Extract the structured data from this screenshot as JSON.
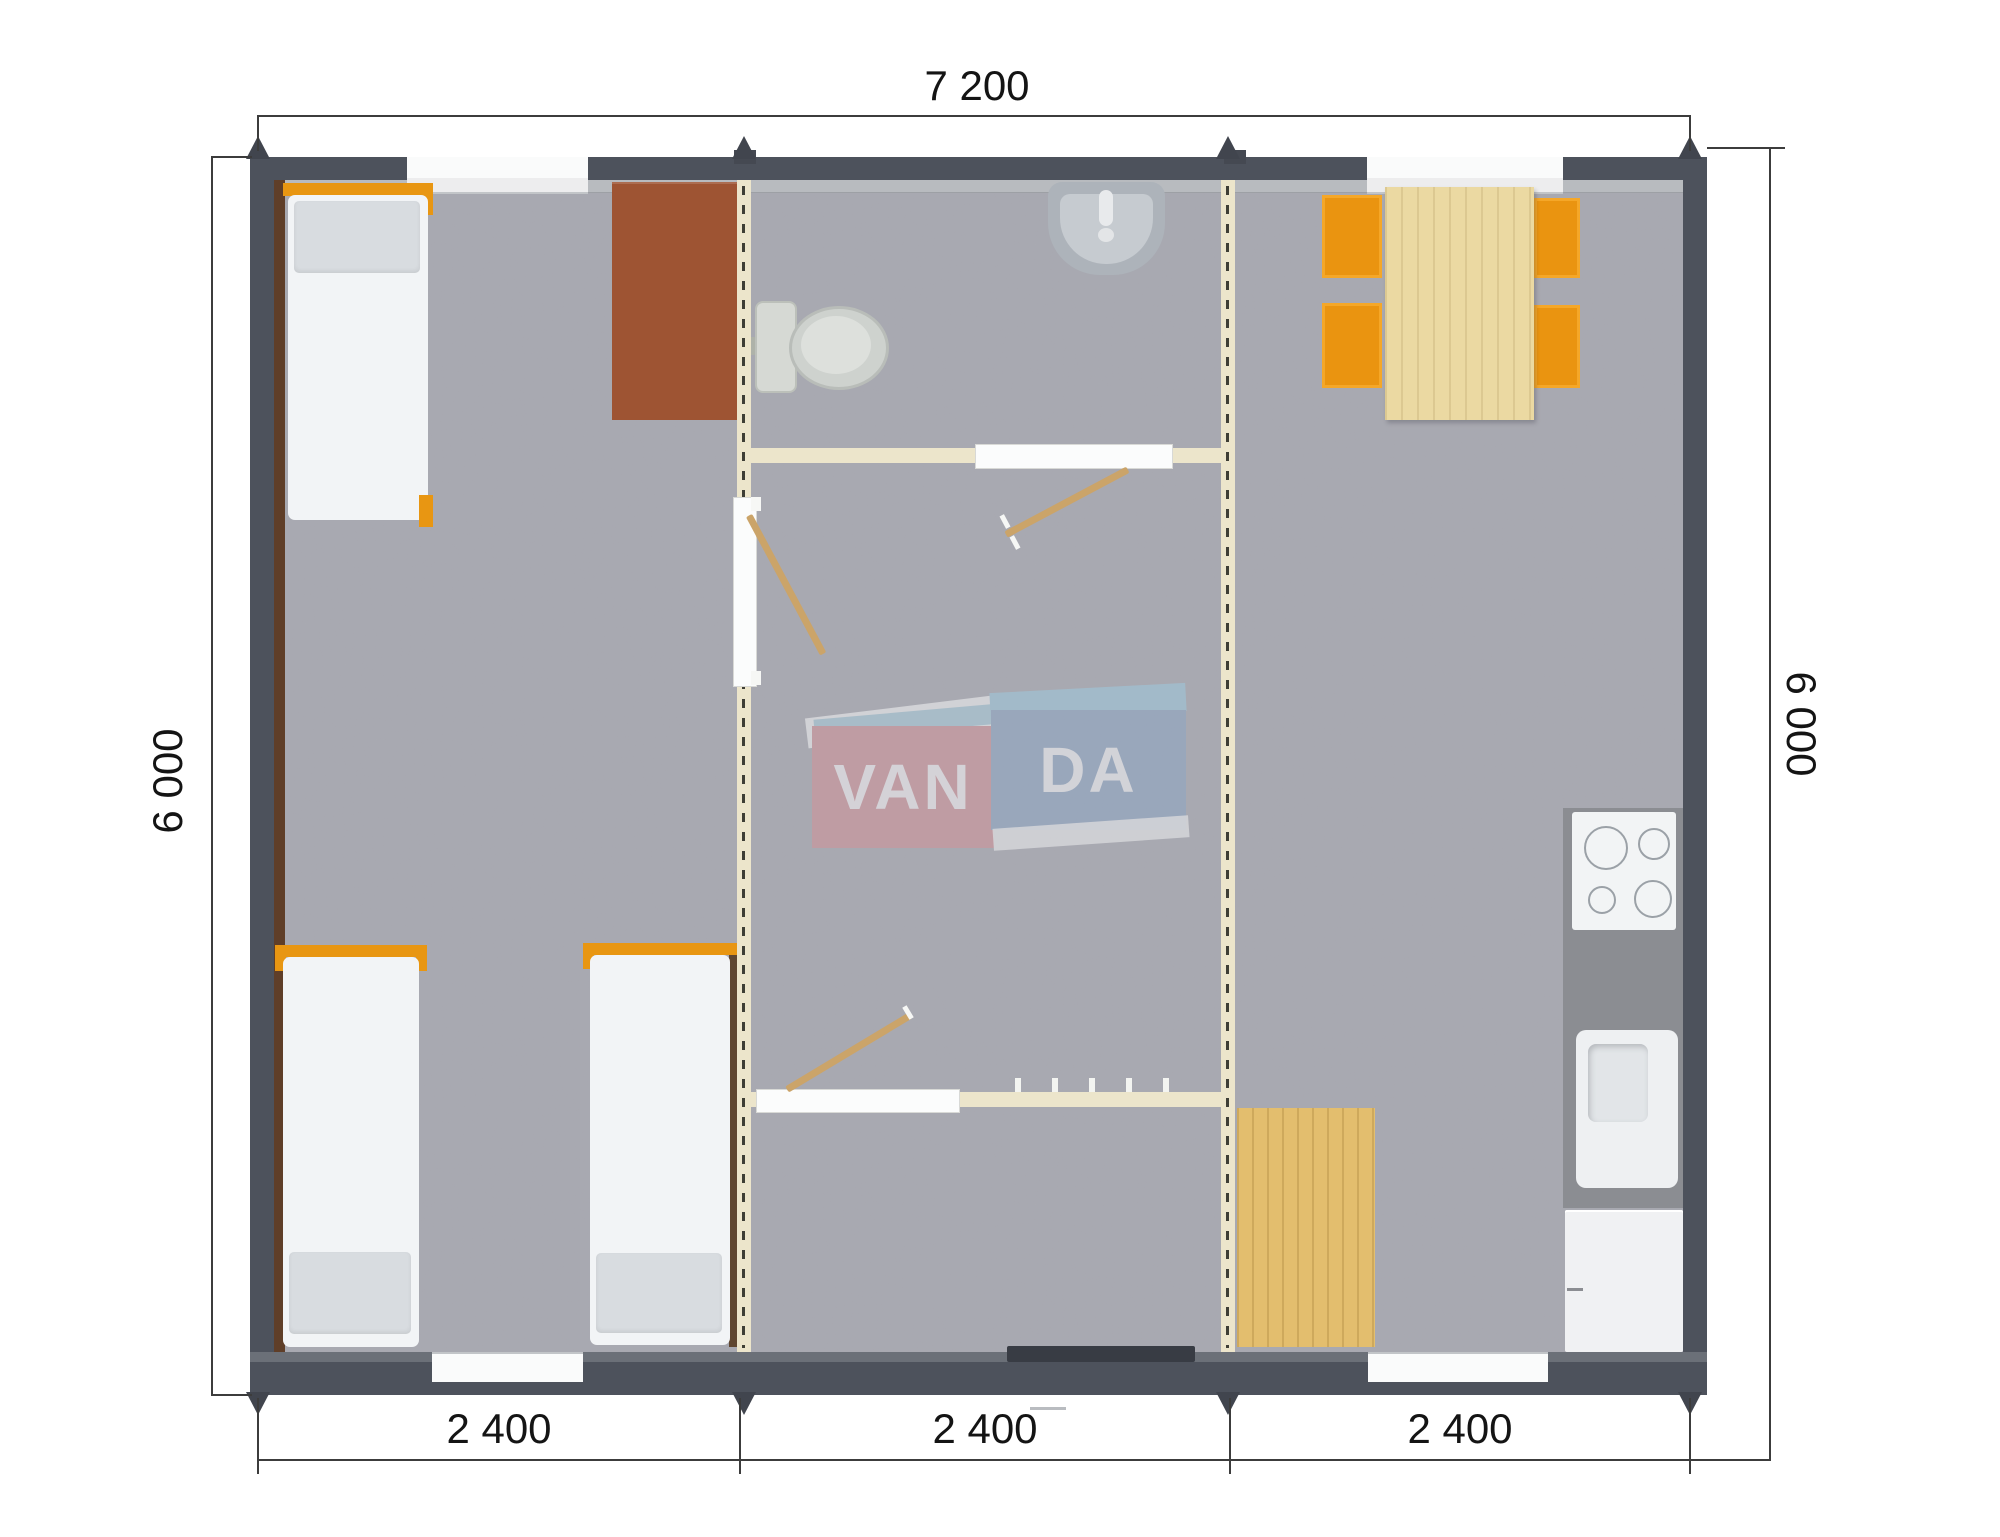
{
  "plan": {
    "brand": "VANDA",
    "dim_top": "7 200",
    "dim_left": "6 000",
    "dim_right": "6 000",
    "dim_bottom": [
      "2 400",
      "2 400",
      "2 400"
    ],
    "logo": {
      "left_text": "VAN",
      "right_text": "DA"
    },
    "colors": {
      "wall": "#4d525c",
      "wall_liner": "#b8bbbf",
      "floor": "#a8a9b1",
      "partition_wall": "#ece5cb",
      "bed_frame_orange": "#e89612",
      "chair_orange": "#ea9410",
      "desk_brown": "#9e5433",
      "table_wood": "#ebd9a2",
      "mat_wood": "#e3be6e",
      "kitchen_counter": "#8b8d92",
      "logo_pink": "#d59198",
      "logo_blue": "#8ca6c6",
      "logo_blue_light": "#9ecbe0",
      "dimension_line": "#3c3c3c"
    }
  }
}
